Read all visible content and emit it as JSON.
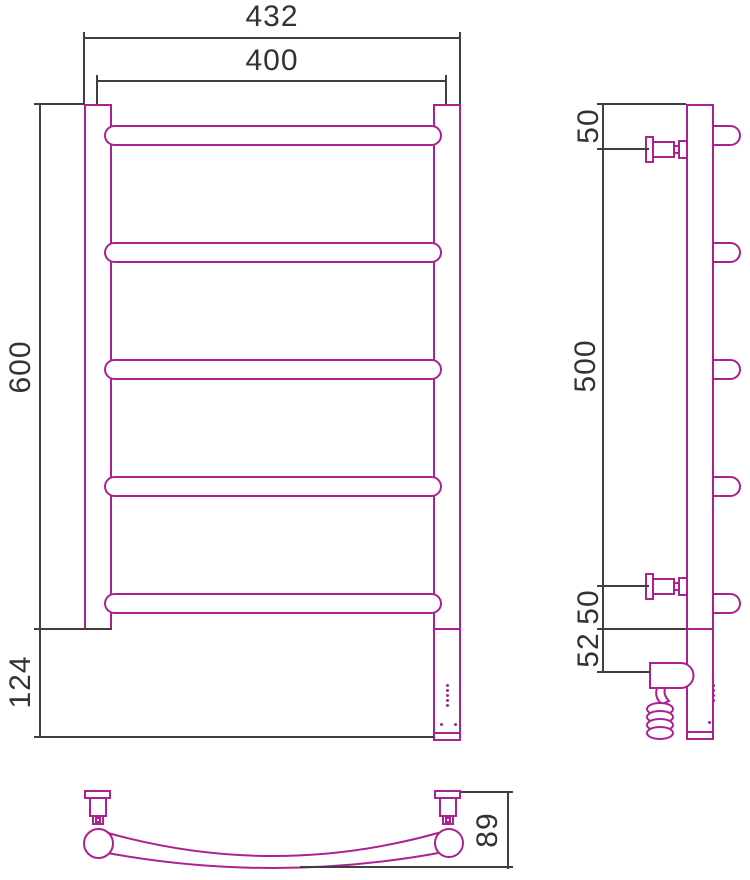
{
  "drawing": {
    "type": "technical-drawing",
    "subject": "ladder towel rail — front, side and top views",
    "colors": {
      "outline": "#ac2192",
      "dimension": "#3f3f3f",
      "background": "#ffffff"
    }
  },
  "dimensions": {
    "front": {
      "outer_width": "432",
      "axis_width": "400",
      "height": "600",
      "lower_height": "124"
    },
    "side": {
      "top_offset": "50",
      "bracket_span": "500",
      "bottom_offset": "50",
      "heater_offset": "52"
    },
    "top": {
      "rail_depth": "89"
    }
  }
}
